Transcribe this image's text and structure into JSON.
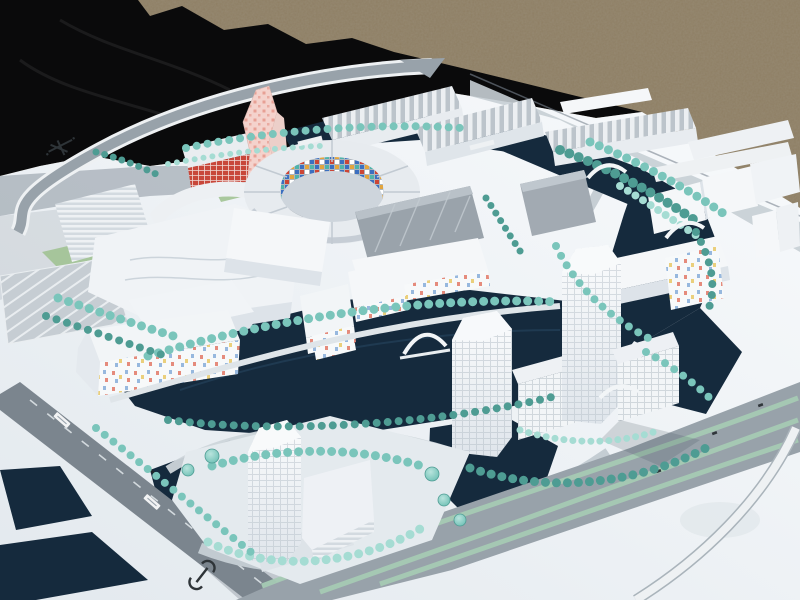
{
  "palette": {
    "gravel": "#8e7e63",
    "tarp": "#0a0a0b",
    "board_light": "#f8fafc",
    "board_dark": "#e3e9ee",
    "shadow": "#5f6c7a",
    "water": "#152a3d",
    "water_hl": "#2a4a66",
    "road_dark": "#7b858e",
    "road_mid": "#98a2aa",
    "road_light": "#c6ced4",
    "lane_white": "#e9eef1",
    "tree": "#7ac5bb",
    "tree_dark": "#4e9c93",
    "tree_light": "#a5dcd3",
    "grass": "#9dc18e",
    "hedge": "#a6cbb4",
    "bldg_white": "#f5f7f9",
    "bldg_face": "#dde3e9",
    "bldg_shade": "#c2cad2",
    "bldg_gray": "#9aa3ab",
    "bldg_darkgray": "#5a6269",
    "pink": "#f4d2cc",
    "pink_dot": "#e69a8f",
    "mosaic_red": "#cc4536",
    "mosaic_blue": "#3b6fc0",
    "mosaic_orange": "#e2a53f",
    "mosaic_teal": "#4fb3ab",
    "conf_red": "#e58b7c",
    "conf_yellow": "#eacf7c",
    "conf_blue": "#97b8de",
    "glyph": "#2e3438"
  },
  "icons": {
    "board-logo-icon": "hand-drawn-cross-mark",
    "station-symbol-icon": "rail-transit-glyph"
  },
  "marks": {
    "road_label_count": 2,
    "bridge_count": 6
  }
}
